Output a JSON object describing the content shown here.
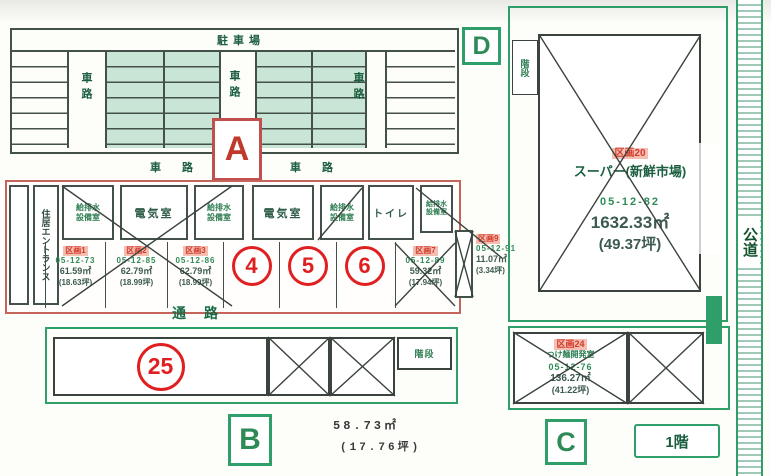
{
  "parking": {
    "label": "駐車場",
    "lane": "車路",
    "lane_spaced": "車 路"
  },
  "markers": {
    "a": "A",
    "b": "B",
    "c": "C",
    "d": "D",
    "floor": "1階"
  },
  "rooms": {
    "electric": "電気室",
    "toilet": "トイレ",
    "stairs": "階段",
    "entrance": "住居エントランス",
    "storage_line1": "給排水",
    "storage_line2": "設備室",
    "passage": "通　路",
    "public_road": "公道"
  },
  "units": {
    "u1": {
      "id": "区画1",
      "code": "05-12-73",
      "sqm": "61.59㎡",
      "tsubo": "(18.63坪)"
    },
    "u2": {
      "id": "区画2",
      "code": "05-12-85",
      "sqm": "62.79㎡",
      "tsubo": "(18.99坪)"
    },
    "u3": {
      "id": "区画3",
      "code": "05-12-86",
      "sqm": "62.79㎡",
      "tsubo": "(18.99坪)"
    },
    "u7": {
      "id": "区画7",
      "code": "05-12-89",
      "sqm": "59.32㎡",
      "tsubo": "(17.94坪)"
    },
    "u9": {
      "id": "区画9",
      "code": "05-12-91",
      "sqm": "11.07㎡",
      "tsubo": "(3.34坪)"
    },
    "u20": {
      "id": "区画20",
      "name": "スーパー(新鮮市場)",
      "code": "05-12-82",
      "sqm": "1632.33㎡",
      "tsubo": "(49.37坪)"
    },
    "u24": {
      "id": "区画24",
      "name": "つけ麺開発室",
      "code": "05-12-76",
      "sqm": "136.27㎡",
      "tsubo": "(41.22坪)"
    }
  },
  "available_units": {
    "c4": "4",
    "c5": "5",
    "c6": "6",
    "c25": "25"
  },
  "b_block": {
    "sqm": "58.73㎡",
    "tsubo": "(17.76坪)"
  },
  "colors": {
    "green": "#2f9e68",
    "dark_green": "#1b5e3f",
    "red": "#e02020",
    "section_red": "#c4645a"
  }
}
